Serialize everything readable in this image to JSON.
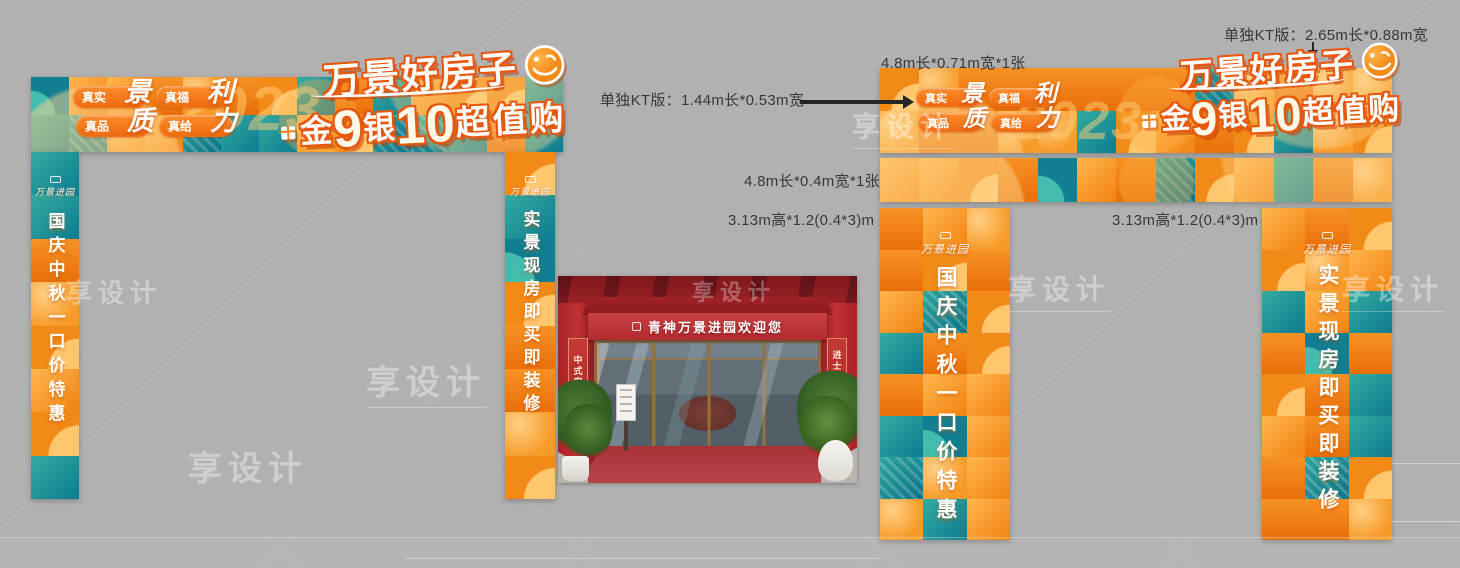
{
  "background_color": "#b1b1b1",
  "palette": {
    "orange": "#f28a17",
    "orange_light": "#ffc06a",
    "teal": "#0d7b90",
    "teal_light": "#34aca1",
    "title_outline": "#e8570e",
    "photo_red": "#b5282c",
    "annotation_text": "#383838"
  },
  "gate_design": {
    "title_line1": "万景好房子",
    "title_line2": {
      "char1": "金",
      "num1": "9",
      "char2": "银",
      "num2": "10",
      "tail": "超值购"
    },
    "year": "2023",
    "pills": [
      {
        "text": "真实",
        "script": "景"
      },
      {
        "text": "真福",
        "script": "利"
      },
      {
        "text": "真品",
        "script": "质"
      },
      {
        "text": "真给",
        "script": "力"
      }
    ],
    "logo": "万景进园",
    "left_pillar_text": "国庆中秋一口价特惠",
    "right_pillar_text": "实景现房即买即装修"
  },
  "annotations": {
    "kt_panel_large": "单独KT版：2.65m长*0.88m宽",
    "band_top": "4.8m长*0.71m宽*1张",
    "kt_panel_small": "单独KT版：1.44m长*0.53m宽",
    "band_bottom": "4.8m长*0.4m宽*1张",
    "pillar_left": "3.13m高*1.2(0.4*3)m",
    "pillar_right": "3.13m高*1.2(0.4*3)m"
  },
  "photo": {
    "awning_sign": "青神万景进园欢迎您",
    "left_column_banner": "中式府邸",
    "right_column_banner": "进士文化",
    "right_column_banner_lower": "第"
  },
  "watermark": {
    "text": "享设计"
  }
}
